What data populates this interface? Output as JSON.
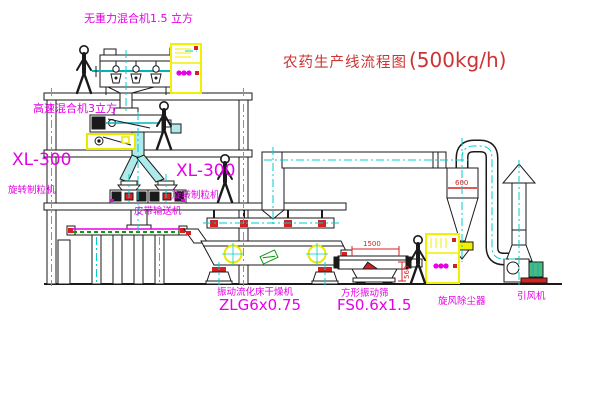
{
  "title": {
    "text": "农药生产线流程图",
    "capacity": "(500kg/h)"
  },
  "equipment_labels": {
    "gravity_free_mixer": "无重力混合机1.5 立方",
    "high_speed_mixer": "高速混合机3立方",
    "granulator_left": {
      "model": "XL-300",
      "name": "旋转制粒机"
    },
    "granulator_center": {
      "model": "XL-300",
      "name": "旋转制粒机"
    },
    "belt_conveyor": "皮带输送机",
    "fluid_bed_dryer": {
      "name": "振动流化床干燥机",
      "model": "ZLG6x0.75"
    },
    "square_vibrating_sieve": {
      "name": "方形振动筛",
      "model": "FS0.6x1.5"
    },
    "cyclone_dust_collector": "旋风除尘器",
    "induced_draft_fan": "引风机"
  },
  "dimensions": {
    "sieve_length": "1500",
    "cyclone_diameter": "600",
    "sieve_outlet_height": "560"
  },
  "colors": {
    "label_magenta": "#e500e5",
    "title_red": "#cc3333",
    "dimension_red": "#d42222",
    "centerline_cyan": "#00cccc",
    "cabinet_yellow": "#f0f000",
    "pipe_fill_cyan": "#aeeaea",
    "detail_green": "#0a9a0a",
    "fan_motor_green": "#4db87f",
    "line_black": "#1a1a1a",
    "background": "#ffffff"
  }
}
